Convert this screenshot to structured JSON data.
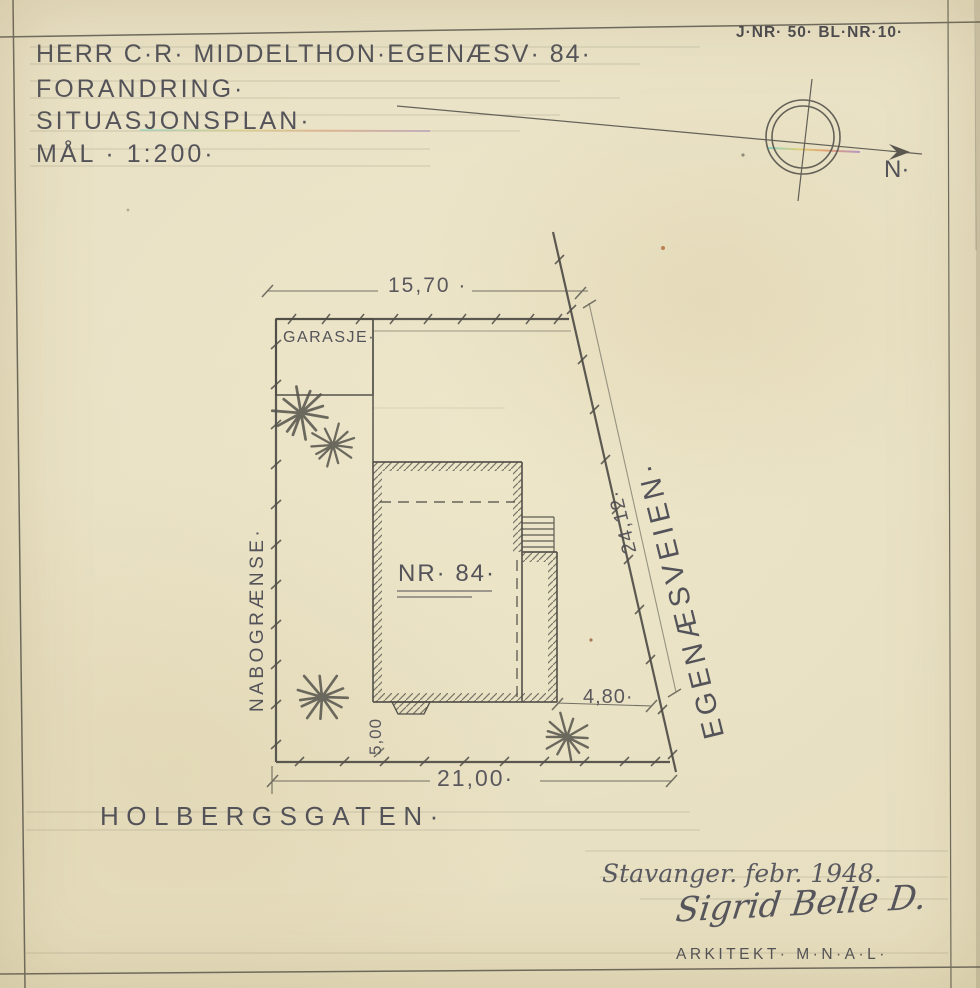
{
  "sheet": {
    "paper_color": "#e9e1c4",
    "ink_color": "#46464f",
    "pencil_color": "#55534c",
    "header": {
      "line1": "HERR C·R· MIDDELTHON·EGENÆSV· 84·",
      "line2": "FORANDRING·",
      "line3": "SITUASJONSPLAN·",
      "line4": "MÅL · 1:200·",
      "journal_ref": "J·NR· 50· BL·NR·10·"
    },
    "compass": {
      "north_label": "N·"
    },
    "footer": {
      "place_date": "Stavanger. febr. 1948.",
      "signature": "Sigrid Belle D.",
      "credential": "ARKITEKT· M·N·A·L·"
    }
  },
  "plan": {
    "labels": {
      "garage": "GARASJE·",
      "house_number": "NR· 84·",
      "boundary_left": "NABOGRÆNSE·",
      "street_right": "EGENÆSVEIEN·",
      "street_bottom": "HOLBERGSGATEN·"
    },
    "dimensions": {
      "top_width": "15,70 ·",
      "bottom_width": "21,00·",
      "street_side_length": "24,12·",
      "house_to_street": "4,80·",
      "house_to_boundary": "5,00"
    }
  }
}
